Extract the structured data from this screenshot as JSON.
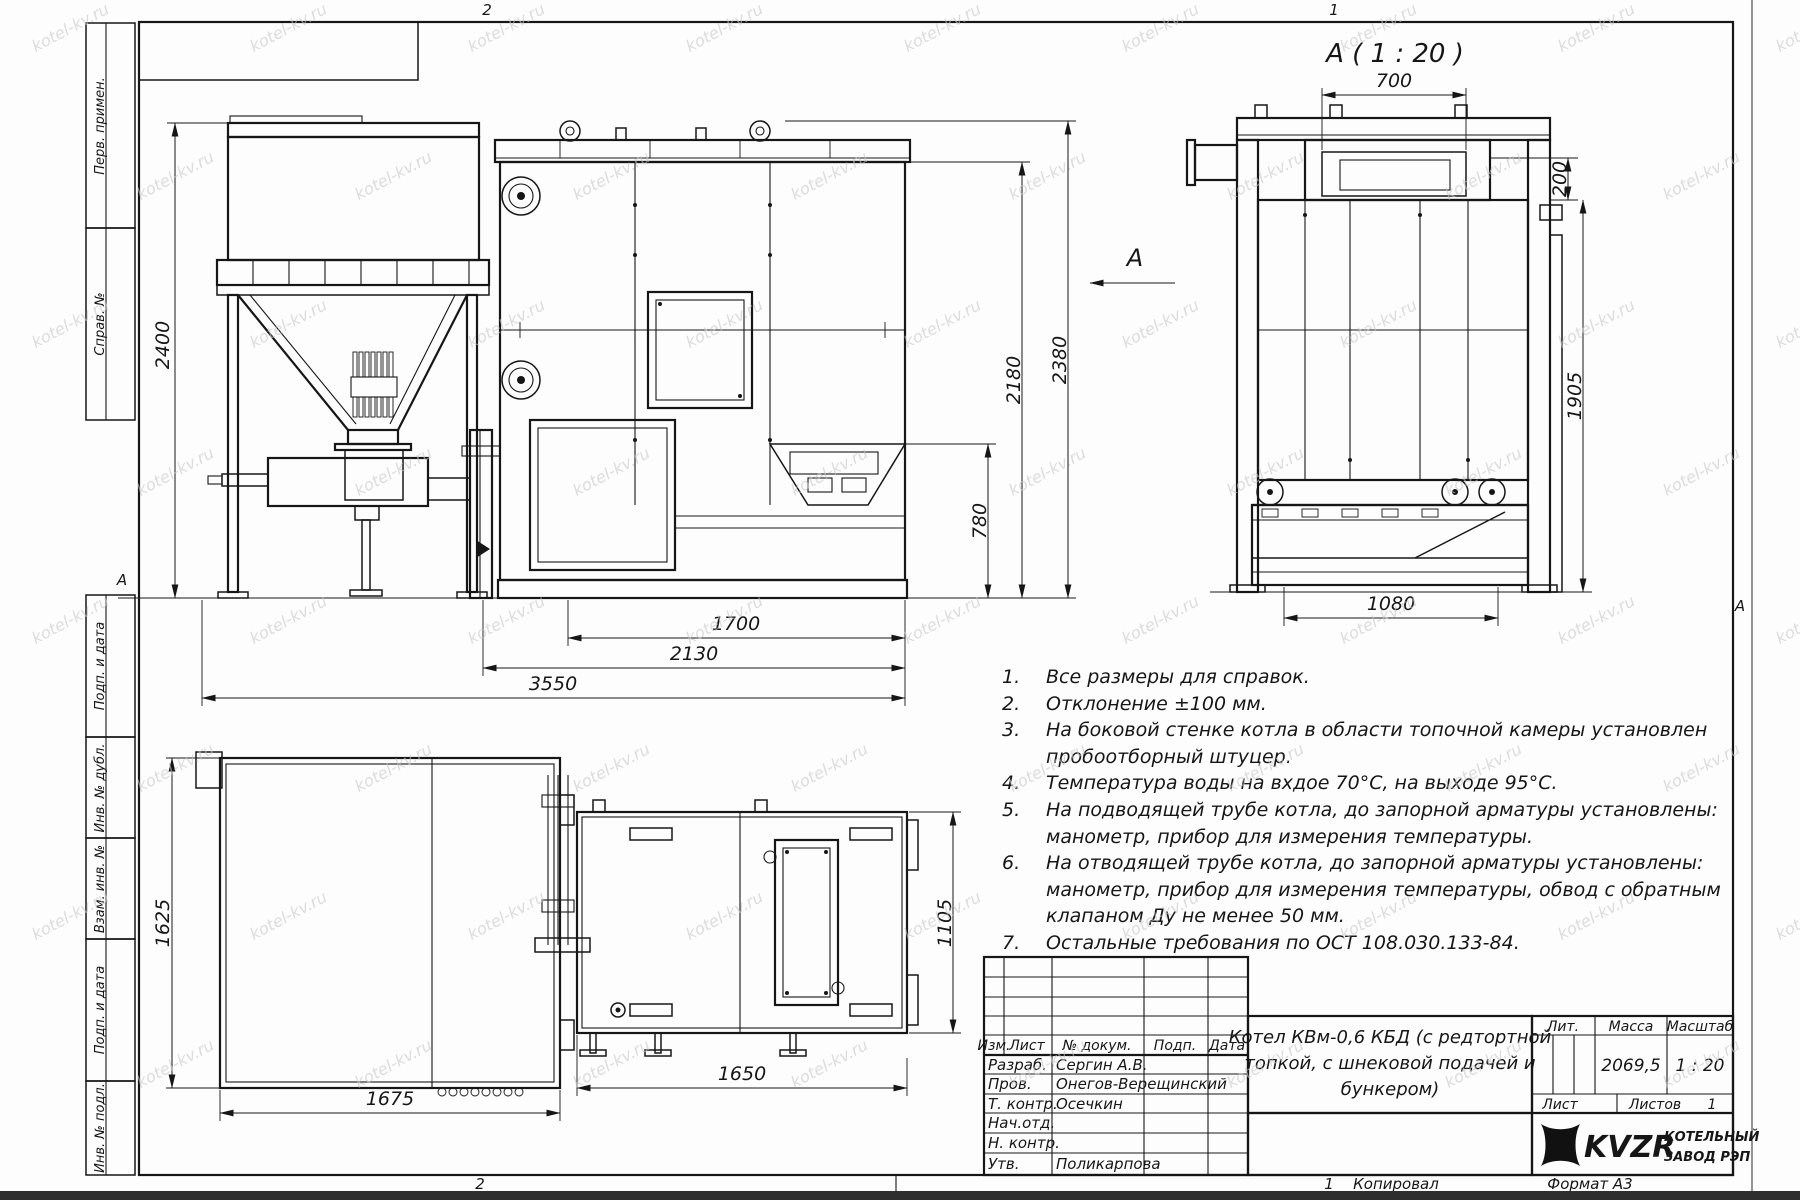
{
  "frame": {
    "zone_top_left": "2",
    "zone_top_right": "1",
    "zone_bottom_left": "2",
    "zone_bottom_right": "1",
    "zone_left": "А",
    "zone_right": "А",
    "copied": "Копировал",
    "format": "Формат А3"
  },
  "watermark": {
    "text": "kotel-kv.ru",
    "color": "#c7c7c7"
  },
  "sidebar": {
    "items": [
      "Перв. примен.",
      "Справ. №",
      "Подп. и дата",
      "Инв. № дубл.",
      "Взам. инв. №",
      "Подп. и дата",
      "Инв. № подл."
    ]
  },
  "views": {
    "front": {
      "d2400": "2400",
      "d2380": "2380",
      "d2180": "2180",
      "d780": "780",
      "d1700": "1700",
      "d2130": "2130",
      "d3550": "3550",
      "view_label": "А"
    },
    "section": {
      "title": "А ( 1 : 20 )",
      "d700": "700",
      "d200": "200",
      "d1905": "1905",
      "d1080": "1080"
    },
    "plan_bunker": {
      "d1625": "1625",
      "d1675": "1675"
    },
    "plan_boiler": {
      "d1650": "1650",
      "d1105": "1105"
    }
  },
  "notes": {
    "lines": [
      {
        "num": "1.",
        "text": "Все размеры для справок."
      },
      {
        "num": "2.",
        "text": "Отклонение ±100 мм."
      },
      {
        "num": "3.",
        "text": "На боковой стенке котла в области топочной камеры установлен"
      },
      {
        "num": "",
        "text": "пробоотборный штуцер."
      },
      {
        "num": "4.",
        "text": "Температура воды на вхдое 70°С, на выходе 95°С."
      },
      {
        "num": "5.",
        "text": "На подводящей трубе котла, до запорной арматуры установлены:"
      },
      {
        "num": "",
        "text": "манометр, прибор для измерения температуры."
      },
      {
        "num": "6.",
        "text": "На отводящей трубе котла, до запорной арматуры установлены:"
      },
      {
        "num": "",
        "text": "манометр, прибор для измерения температуры, обвод с обратным"
      },
      {
        "num": "",
        "text": "клапаном Ду не менее 50 мм."
      },
      {
        "num": "7.",
        "text": "Остальные требования по ОСТ 108.030.133-84."
      }
    ]
  },
  "title_block": {
    "header": {
      "izm": "Изм.",
      "list": "Лист",
      "doc": "№ докум.",
      "podp": "Подп.",
      "data": "Дата"
    },
    "rows": [
      {
        "label": "Разраб.",
        "name": "Сергин А.В."
      },
      {
        "label": "Пров.",
        "name": "Онегов-Верещинский"
      },
      {
        "label": "Т. контр.",
        "name": "Осечкин"
      },
      {
        "label": "Нач.отд.",
        "name": ""
      },
      {
        "label": "Н. контр.",
        "name": ""
      },
      {
        "label": "Утв.",
        "name": "Поликарпова"
      }
    ],
    "title_lines": [
      "Котел КВм-0,6 КБД (с редтортной",
      "топкой, с шнековой подачей и",
      "бункером)"
    ],
    "lit": "Лит.",
    "massa": "Масса",
    "scale": "Масштаб",
    "massa_value": "2069,5",
    "scale_value": "1 : 20",
    "sheet": "Лист",
    "sheets": "Листов",
    "sheets_value": "1",
    "logo": "KVZR",
    "org1": "КОТЕЛЬНЫЙ",
    "org2": "ЗАВОД РЭП"
  }
}
